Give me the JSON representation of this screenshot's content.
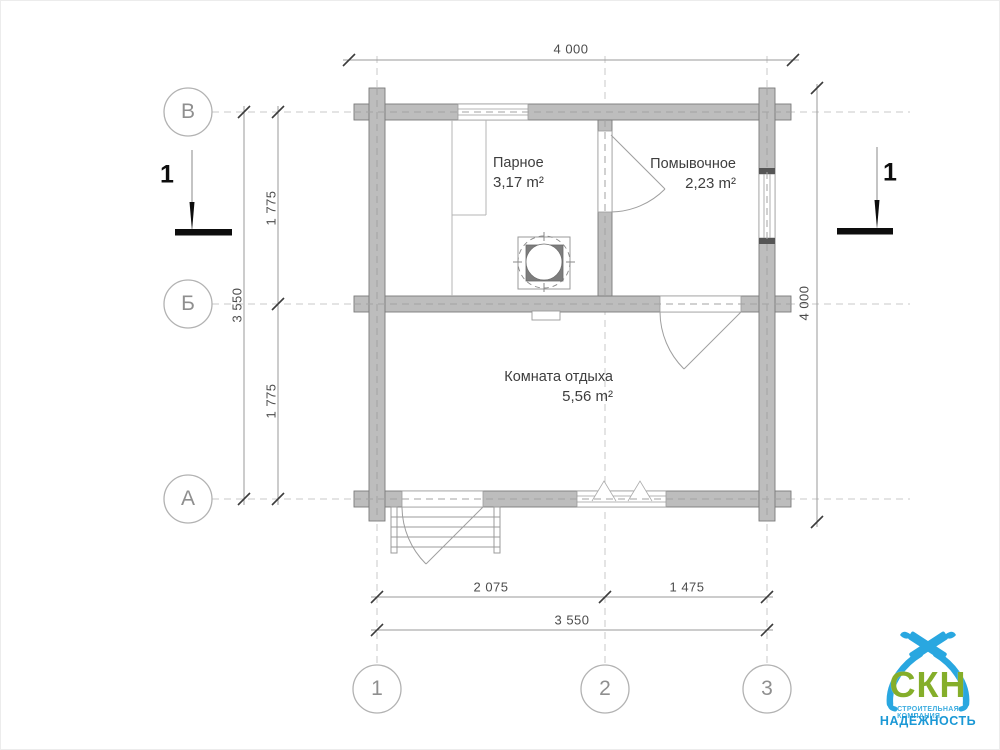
{
  "floor_plan": {
    "rooms": [
      {
        "name": "Парное",
        "area": "3,17 m²"
      },
      {
        "name": "Помывочное",
        "area": "2,23 m²"
      },
      {
        "name": "Комната отдыха",
        "area": "5,56 m²"
      }
    ],
    "dimensions": {
      "top_overall": "4 000",
      "right_overall": "4 000",
      "left_total": "3 550",
      "left_upper": "1 775",
      "left_lower": "1 775",
      "bottom_left": "2 075",
      "bottom_right": "1 475",
      "bottom_total": "3 550"
    },
    "grid_axes": {
      "rows": [
        "В",
        "Б",
        "А"
      ],
      "cols": [
        "1",
        "2",
        "3"
      ]
    },
    "section_marks": {
      "left": "1",
      "right": "1"
    }
  },
  "logo": {
    "abbr": "СКН",
    "line1": "СТРОИТЕЛЬНАЯ КОМПАНИЯ",
    "line2": "НАДЁЖНОСТЬ"
  },
  "colors": {
    "wall_fill": "#bdbdbd",
    "wall_stroke": "#7a7a7a",
    "grid_dash": "#c9c9c9",
    "dim_line": "#9a9a9a",
    "logo_blue": "#29a7e0",
    "logo_green": "#85ae2a",
    "logo_text_blue": "#1b98d5"
  }
}
